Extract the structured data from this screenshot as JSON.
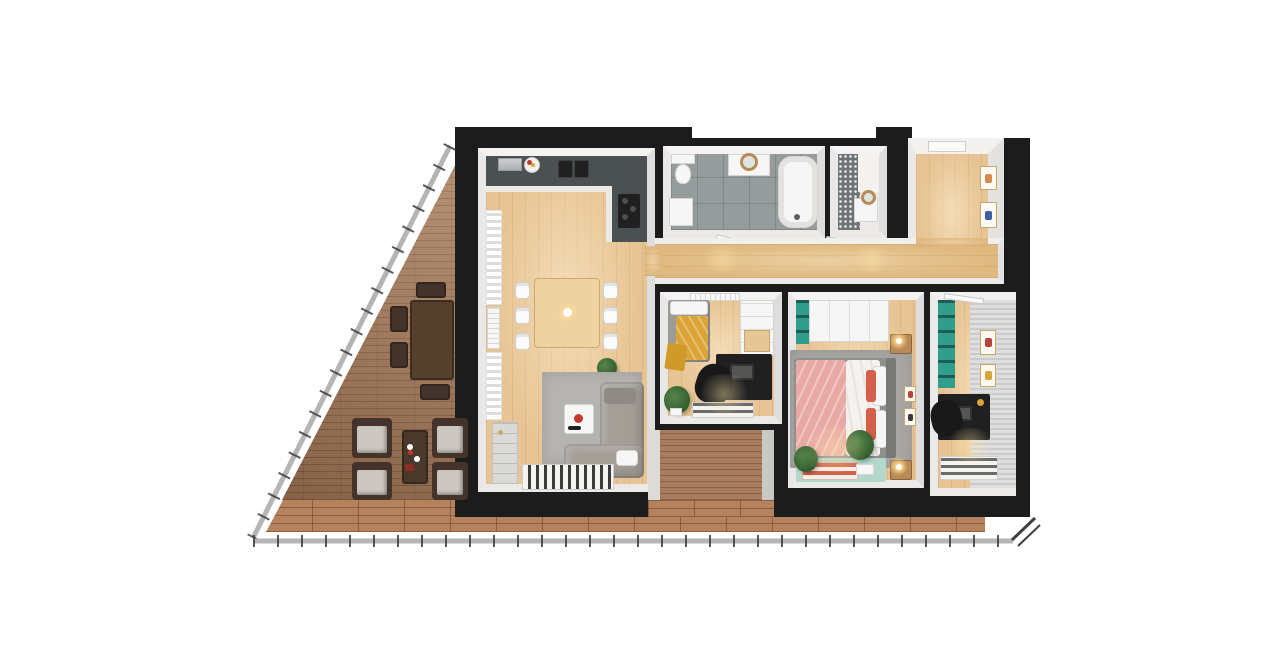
{
  "scene": {
    "title": "3D apartment floor plan, top-down view",
    "background": "#ffffff",
    "rooms": [
      {
        "name": "terrace",
        "floor": "wood-deck"
      },
      {
        "name": "living-dining-kitchen",
        "floor": "light-oak"
      },
      {
        "name": "bathroom",
        "floor": "grey-tile"
      },
      {
        "name": "wc",
        "floor": "mosaic-tile"
      },
      {
        "name": "entrance-hallway",
        "floor": "light-oak"
      },
      {
        "name": "corridor",
        "floor": "light-oak"
      },
      {
        "name": "office-bedroom",
        "floor": "light-oak"
      },
      {
        "name": "master-bedroom",
        "floor": "light-oak"
      },
      {
        "name": "study",
        "floor": "light-oak"
      },
      {
        "name": "loggia-balcony",
        "floor": "wood-deck"
      },
      {
        "name": "walkway-balcony",
        "floor": "terracotta-tile"
      }
    ],
    "furniture": [
      "outdoor-dining-table",
      "outdoor-chairs",
      "lounge-chairs",
      "outdoor-coffee-table",
      "kitchen-counter",
      "cooktop",
      "double-sink",
      "coffee-machine",
      "fruit-bowl",
      "dining-table",
      "dining-chairs",
      "pendant-lamp",
      "corner-sofa",
      "coffee-table",
      "area-rug",
      "striped-rugs",
      "tall-cabinet",
      "curtains",
      "radiator",
      "toilet",
      "washing-machine",
      "vanity-with-mirror",
      "bathtub",
      "wc-basin-with-mirror",
      "picture-frames",
      "sofa-bed",
      "mustard-throw",
      "wardrobe",
      "desk",
      "desk-chair",
      "laptop",
      "plants",
      "double-bed",
      "pink-duvet",
      "coral-pillows",
      "nightstands",
      "bedside-lamps",
      "teal-wardrobe",
      "teal-bookshelf",
      "teal-floor-mat",
      "door-leaves",
      "railing"
    ],
    "counts": {
      "dining_chairs": 6,
      "lounge_chairs": 4,
      "outdoor_chairs": 4,
      "hallway_frames": 3,
      "study_frames": 2,
      "bedroom_frames": 2,
      "door_leaves": 3,
      "bedrooms": 3,
      "bathrooms": 2
    }
  },
  "colors": {
    "wall": "#1c1c1c",
    "liner": "#f0efed",
    "wood": "#e7c493",
    "woodDeep": "#dfb97f",
    "terraceDeck": "#9c7355",
    "walkwayTile": "#b5825e",
    "loggiaDeck": "#a87c5c",
    "bathTile": "#959c9c",
    "wcMosaic": "#6e7476",
    "railing": "#b5b5b5",
    "railingTick": "#3e3e3e",
    "rug": "#b6b4b1",
    "rugBedroom": "#a9a7a4",
    "sofa": "#a49e97",
    "white": "#f6f6f6",
    "furnitureBlack": "#202020",
    "counter": "#4b5053",
    "teal": "#2f9e8c",
    "tealMat": "#b3d6cd",
    "pink": "#e8a9a4",
    "coral": "#d4604c",
    "mustard": "#dba437",
    "woodFurniture": "#b98a56",
    "tableWood": "#eed2a2",
    "outdoorWood": "#55402e",
    "outdoorChair": "#43332a",
    "cushion": "#ccc7c0",
    "frameGold": "#c9a96a",
    "plantDark": "#2f5a2c",
    "plantLight": "#55854a",
    "glow": "#ffd98c",
    "silver": "#cdd1d4",
    "redAccent": "#c0392b"
  }
}
